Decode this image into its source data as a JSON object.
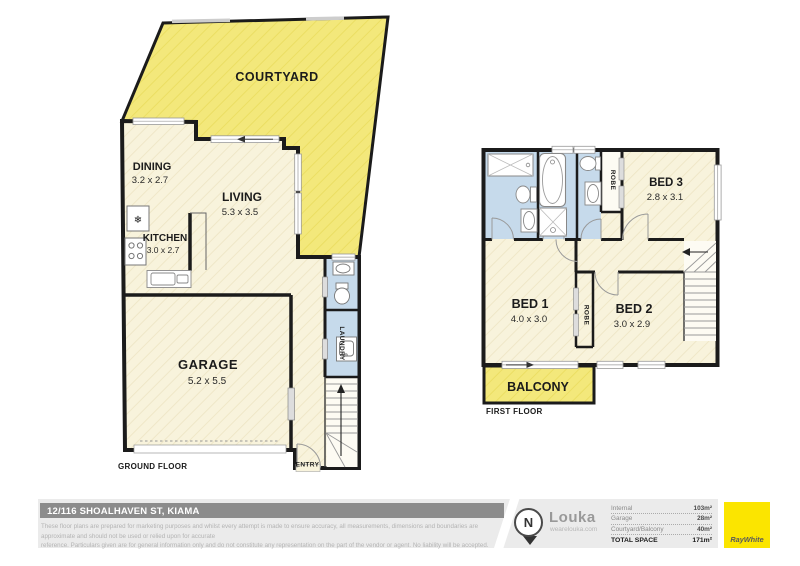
{
  "plan": {
    "ground": {
      "floor_label": "GROUND FLOOR",
      "courtyard_label": "COURTYARD",
      "dining_name": "DINING",
      "dining_dims": "3.2 x 2.7",
      "living_name": "LIVING",
      "living_dims": "5.3 x 3.5",
      "kitchen_name": "KITCHEN",
      "kitchen_dims": "3.0 x 2.7",
      "garage_name": "GARAGE",
      "garage_dims": "5.2 x 5.5",
      "laundry_label": "LAUNDRY",
      "entry_label": "ENTRY"
    },
    "first": {
      "floor_label": "FIRST FLOOR",
      "bed1_name": "BED 1",
      "bed1_dims": "4.0 x 3.0",
      "bed2_name": "BED 2",
      "bed2_dims": "3.0 x 2.9",
      "bed3_name": "BED 3",
      "bed3_dims": "2.8 x 3.1",
      "robe_bed3_label": "ROBE",
      "robe_bed1_label": "ROBE",
      "balcony_label": "BALCONY"
    },
    "symbols": {
      "fridge": "❄"
    }
  },
  "footer": {
    "address": "12/116 SHOALHAVEN ST, KIAMA",
    "disclaimer_line1": "These floor plans are prepared for marketing purposes and whilst every attempt is made to ensure accuracy, all measurements, dimensions and boundaries are approximate and should not be used or relied upon for accurate",
    "disclaimer_line2": "reference. Particulars given are for general information only and do not constitute any representation on the part of the vendor or agent. No liability will be accepted.",
    "north_label": "N",
    "brand_name": "Louka",
    "brand_url": "wearelouka.com",
    "areas": [
      {
        "label": "Internal",
        "value": "103m²"
      },
      {
        "label": "Garage",
        "value": "28m²"
      },
      {
        "label": "Courtyard/Balcony",
        "value": "40m²"
      }
    ],
    "total_label": "TOTAL SPACE",
    "total_value": "171m²",
    "agency": "RayWhite"
  },
  "colors": {
    "floor_cream": "#F8F3DC",
    "outdoor_yellow": "#F3E87B",
    "wet_area_blue": "#C6DAEB",
    "wall_black": "#1B1B1B",
    "address_bar_gray": "#8C8C8C",
    "band_gray": "#EBEBEB",
    "raywhite_yellow": "#FBE500",
    "brand_gray": "#999999"
  }
}
